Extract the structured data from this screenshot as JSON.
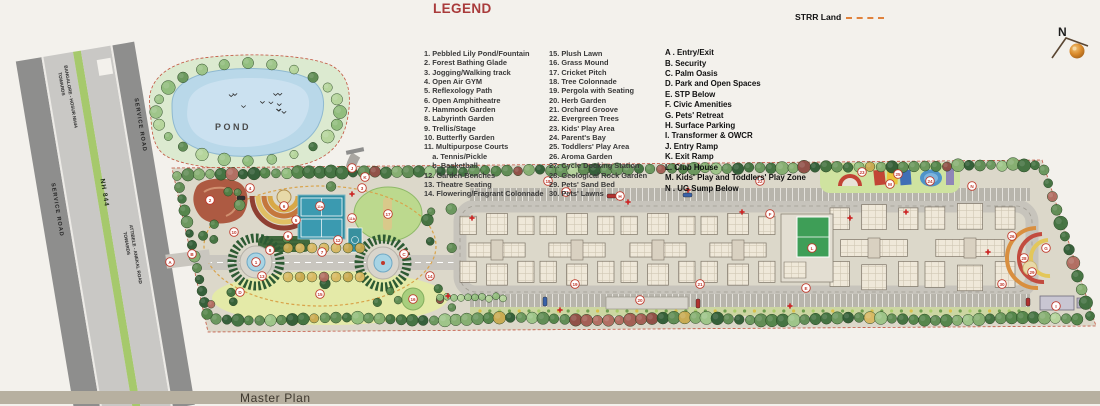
{
  "legend": {
    "heading": "LEGEND",
    "numbered_col1": [
      "1. Pebbled Lily Pond/Fountain",
      "2. Forest Bathing Glade",
      "3. Jogging/Walking track",
      "4. Open Air GYM",
      "5. Reflexology Path",
      "6. Open Amphitheatre",
      "7. Hammock Garden",
      "8. Labyrinth Garden",
      "9. Trellis/Stage",
      "10. Butterfly Garden",
      "11. Multipurpose Courts",
      "    a. Tennis/Pickle",
      "    b. Basketball",
      "12. Garden Benches",
      "13. Theatre Seating",
      "14. Flowering/Fragrant Colonnade"
    ],
    "numbered_col2": [
      "15. Plush Lawn",
      "16. Grass Mound",
      "17. Cricket Pitch",
      "18. Tree Colonnade",
      "19. Pergola with Seating",
      "20. Herb Garden",
      "21. Orchard Groove",
      "22. Evergreen Trees",
      "23. Kids' Play Area",
      "24. Parent's Bay",
      "25. Toddlers' Play Area",
      "26. Aroma Garden",
      "27. Cycle Docking Station",
      "28. Geological Rock Garden",
      "29. Pets' Sand Bed",
      "30. Pets' Lawns"
    ],
    "lettered": [
      "A . Entry/Exit",
      "B. Security",
      "C. Palm Oasis",
      "D. Park and Open Spaces",
      "E. STP Below",
      "F. Civic Amenities",
      "G. Pets' Retreat",
      "H. Surface Parking",
      "I. Transformer & OWCR",
      "J. Entry Ramp",
      "K. Exit Ramp",
      "L. Club House",
      "M. Kids' Play and Toddlers' Play Zone",
      "N . UG Sump Below"
    ]
  },
  "annotations": {
    "strr_label": "STRR Land",
    "compass_n": "N",
    "pond_label": "POND"
  },
  "roads": {
    "median_label": "NH 844",
    "service_road_left": "SERVICE ROAD",
    "service_road_right": "SERVICE ROAD",
    "towards_top_line1": "TOWARDS",
    "towards_top_line2": "BANGALORE - HOSUR NH44",
    "towards_bottom_line1": "TOWARDS",
    "towards_bottom_line2": "ATTIBELE - ANEKAL ROAD"
  },
  "footer": {
    "label": "Master Plan"
  },
  "markers": {
    "numbers": [
      {
        "n": "1",
        "x": 256,
        "y": 262
      },
      {
        "n": "2",
        "x": 210,
        "y": 200
      },
      {
        "n": "3",
        "x": 362,
        "y": 188
      },
      {
        "n": "4",
        "x": 250,
        "y": 188
      },
      {
        "n": "5",
        "x": 296,
        "y": 220
      },
      {
        "n": "6",
        "x": 284,
        "y": 206
      },
      {
        "n": "7",
        "x": 322,
        "y": 252
      },
      {
        "n": "8",
        "x": 270,
        "y": 250
      },
      {
        "n": "9",
        "x": 288,
        "y": 236
      },
      {
        "n": "10",
        "x": 234,
        "y": 232
      },
      {
        "n": "11a",
        "x": 320,
        "y": 206
      },
      {
        "n": "11b",
        "x": 352,
        "y": 218
      },
      {
        "n": "12",
        "x": 338,
        "y": 240
      },
      {
        "n": "13",
        "x": 262,
        "y": 276
      },
      {
        "n": "14",
        "x": 430,
        "y": 276
      },
      {
        "n": "15",
        "x": 320,
        "y": 294
      },
      {
        "n": "16",
        "x": 413,
        "y": 299
      },
      {
        "n": "17",
        "x": 388,
        "y": 214
      },
      {
        "n": "18",
        "x": 548,
        "y": 181
      },
      {
        "n": "19",
        "x": 575,
        "y": 284
      },
      {
        "n": "20",
        "x": 640,
        "y": 300
      },
      {
        "n": "21",
        "x": 700,
        "y": 284
      },
      {
        "n": "22",
        "x": 760,
        "y": 181
      },
      {
        "n": "23",
        "x": 862,
        "y": 172
      },
      {
        "n": "24",
        "x": 930,
        "y": 181
      },
      {
        "n": "25",
        "x": 898,
        "y": 174
      },
      {
        "n": "26",
        "x": 1012,
        "y": 236
      },
      {
        "n": "27",
        "x": 566,
        "y": 192
      },
      {
        "n": "28",
        "x": 1024,
        "y": 258
      },
      {
        "n": "29",
        "x": 1032,
        "y": 272
      },
      {
        "n": "30",
        "x": 1002,
        "y": 284
      }
    ],
    "letters": [
      {
        "n": "A",
        "x": 170,
        "y": 262
      },
      {
        "n": "B",
        "x": 192,
        "y": 254
      },
      {
        "n": "C",
        "x": 404,
        "y": 254
      },
      {
        "n": "D",
        "x": 240,
        "y": 292
      },
      {
        "n": "E",
        "x": 806,
        "y": 288
      },
      {
        "n": "F",
        "x": 770,
        "y": 214
      },
      {
        "n": "G",
        "x": 1046,
        "y": 248
      },
      {
        "n": "H",
        "x": 620,
        "y": 196
      },
      {
        "n": "I",
        "x": 1056,
        "y": 306
      },
      {
        "n": "J",
        "x": 352,
        "y": 168
      },
      {
        "n": "K",
        "x": 365,
        "y": 177
      },
      {
        "n": "L",
        "x": 812,
        "y": 248
      },
      {
        "n": "M",
        "x": 890,
        "y": 184
      },
      {
        "n": "N",
        "x": 972,
        "y": 186
      }
    ]
  },
  "colors": {
    "legend_heading": "#a93b3b",
    "strr_dash": "#e0823c",
    "footer_bar": "#b7b0a0",
    "median_green": "#a6c96c",
    "pond_blue": "#b9d8e9",
    "site_ground": "#dcd8ca",
    "marker_red": "#c0392b",
    "compass_orange": "#d98a2b"
  }
}
